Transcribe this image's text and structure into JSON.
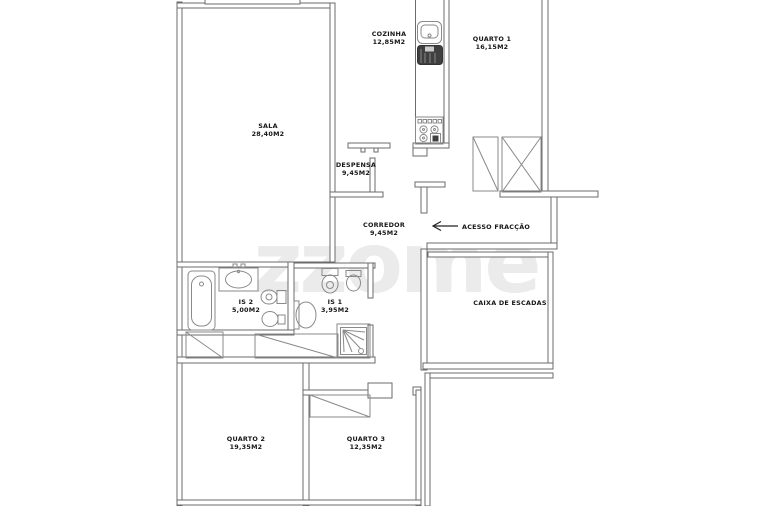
{
  "watermark": {
    "text": "zzome"
  },
  "plan": {
    "rooms": [
      {
        "key": "sala",
        "name": "SALA",
        "area": "28,40M2"
      },
      {
        "key": "cozinha",
        "name": "COZINHA",
        "area": "12,85M2"
      },
      {
        "key": "quarto-1",
        "name": "QUARTO 1",
        "area": "16,15M2"
      },
      {
        "key": "despensa",
        "name": "DESPENSA",
        "area": "9,45M2"
      },
      {
        "key": "corredor",
        "name": "CORREDOR",
        "area": "9,45M2"
      },
      {
        "key": "is-2",
        "name": "IS 2",
        "area": "5,00M2"
      },
      {
        "key": "is-1",
        "name": "IS 1",
        "area": "3,95M2"
      },
      {
        "key": "quarto-2",
        "name": "QUARTO 2",
        "area": "19,35M2"
      },
      {
        "key": "quarto-3",
        "name": "QUARTO 3",
        "area": "12,35M2"
      },
      {
        "key": "caixa-de-escadas",
        "name": "CAIXA DE ESCADAS",
        "area": ""
      }
    ],
    "entry_label": "ACESSO FRACÇÃO"
  }
}
